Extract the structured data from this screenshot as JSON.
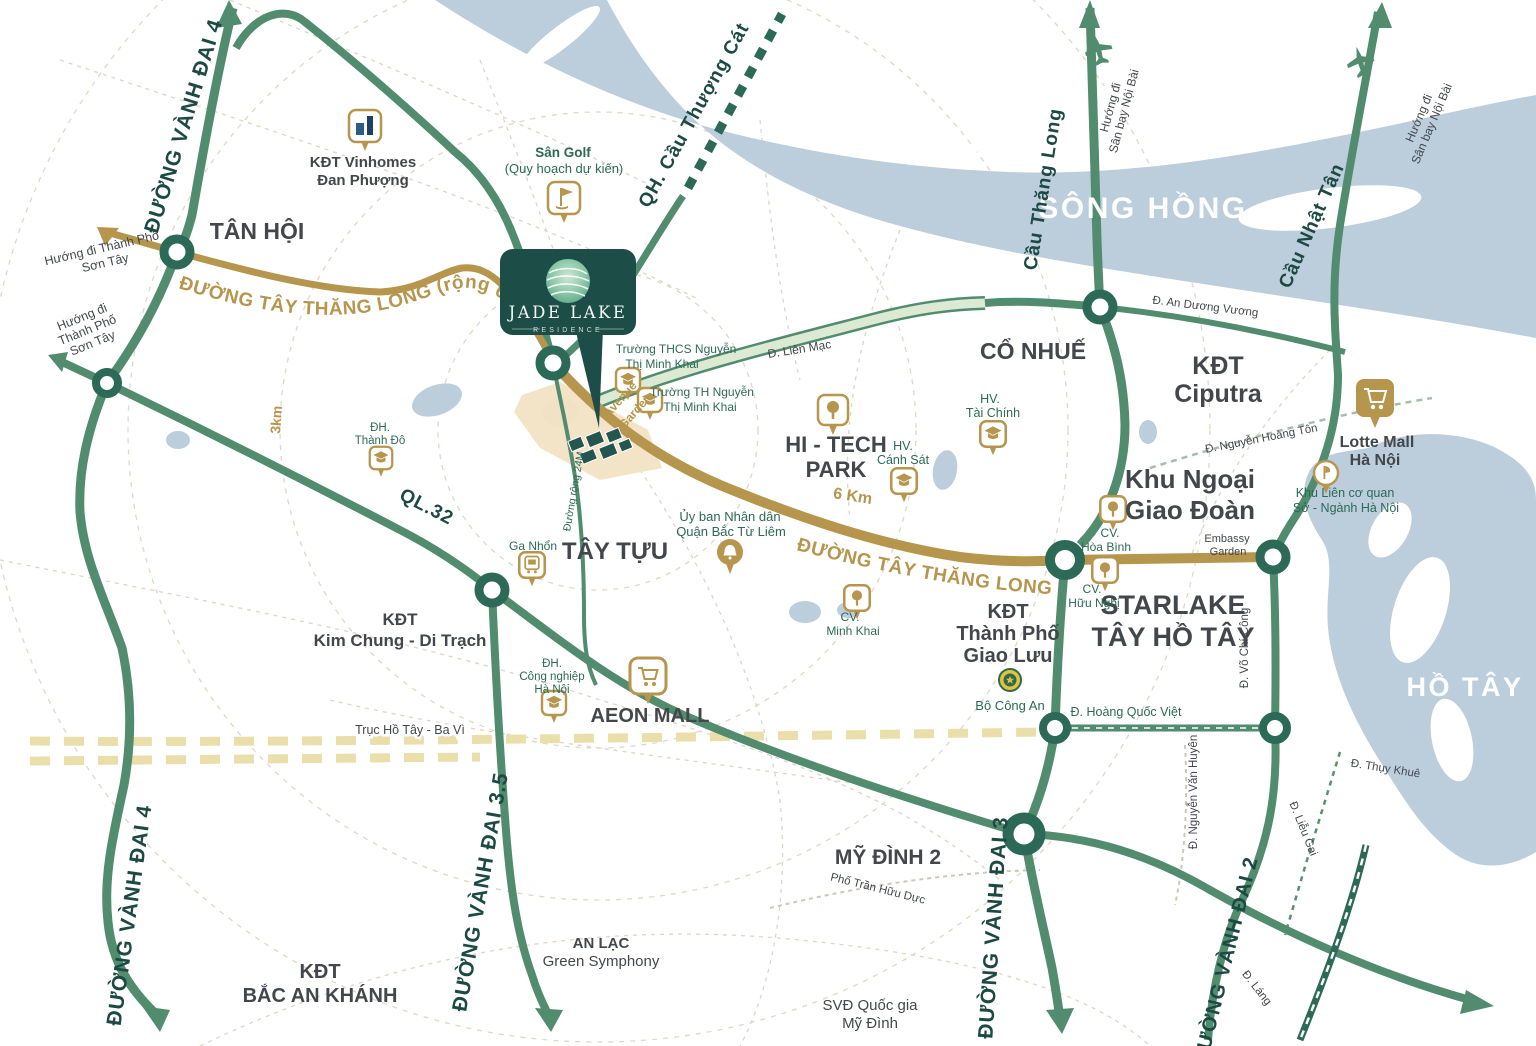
{
  "project": {
    "name": "JADE LAKE",
    "subtitle": "RESIDENCE"
  },
  "waterways": {
    "song_hong": "SÔNG HỒNG",
    "ho_tay": "HỒ TÂY"
  },
  "roads": {
    "vanh_dai_4": "ĐƯỜNG VÀNH ĐAI 4",
    "vanh_dai_4b": "ĐƯỜNG VÀNH ĐAI 4",
    "vanh_dai_35": "ĐƯỜNG VÀNH ĐAI 3.5",
    "vanh_dai_3": "ĐƯỜNG VÀNH ĐAI 3",
    "vanh_dai_2": "ĐƯỜNG VÀNH ĐAI 2",
    "ql32": "QL.32",
    "tay_thang_long_full": "ĐƯỜNG TÂY THĂNG LONG (rộng 60,5m)",
    "tay_thang_long": "ĐƯỜNG TÂY THĂNG LONG",
    "cau_thang_long": "Cầu Thăng Long",
    "cau_nhat_tan": "Cầu Nhật Tân",
    "qh_cau_thuong_cat": "QH. Cầu Thượng Cát",
    "lien_mac": "Đ. Liên Mạc",
    "an_duong_vuong": "Đ. An Dương Vương",
    "nguyen_hoang_ton": "Đ. Nguyễn Hoàng Tôn",
    "hoang_quoc_viet": "Đ. Hoàng Quốc Việt",
    "nguyen_van_huyen": "Đ. Nguyễn Văn Huyên",
    "vo_chi_cong": "Đ. Võ Chí Công",
    "thuy_khue": "Đ. Thụy Khuê",
    "lieu_gai": "Đ. Liễu Gai",
    "lang": "Đ. Láng",
    "tran_huu_duc": "Phố Trần Hữu Dực",
    "duong_rong_24m": "Đường rộng 24M",
    "truc_ho_tay_ba_vi": "Trục Hồ Tây - Ba Vì"
  },
  "directions": {
    "son_tay_a": {
      "l1": "Hướng đi Thành Phố",
      "l2": "Sơn Tây"
    },
    "son_tay_b": {
      "l1": "Hướng đi",
      "l2": "Thành Phố",
      "l3": "Sơn Tây"
    },
    "noi_bai_a": {
      "l1": "Hướng đi",
      "l2": "Sân bay Nội Bài"
    },
    "noi_bai_b": {
      "l1": "Hướng đi",
      "l2": "Sân bay Nội Bài"
    }
  },
  "distances": {
    "ring_3km": "3km",
    "road_6km": "6 Km"
  },
  "areas": {
    "tan_hoi": "TÂN HỘI",
    "co_nhue": "CỔ NHUẾ",
    "tay_tuu": "TÂY TỰU",
    "my_dinh_2": "MỸ ĐÌNH 2",
    "ciputra": {
      "l1": "KĐT",
      "l2": "Ciputra"
    },
    "khu_ngoai_giao": {
      "l1": "Khu Ngoại",
      "l2": "Giao Đoàn"
    },
    "starlake": {
      "l1": "STARLAKE",
      "l2": "TÂY HỒ TÂY"
    },
    "giao_luu": {
      "l1": "KĐT",
      "l2": "Thành Phố",
      "l3": "Giao Lưu"
    },
    "kim_chung": {
      "l1": "KĐT",
      "l2": "Kim Chung - Di Trạch"
    },
    "bac_an_khanh": {
      "l1": "KĐT",
      "l2": "BẮC AN KHÁNH"
    },
    "an_lac": {
      "l1": "AN LẠC",
      "l2": "Green Symphony"
    },
    "svd_my_dinh": {
      "l1": "SVĐ Quốc gia",
      "l2": "Mỹ Đình"
    },
    "embassy_garden": {
      "l1": "Embassy",
      "l2": "Garden"
    },
    "avenue_garden": {
      "l1": "Avenue",
      "l2": "Garden"
    }
  },
  "pois": {
    "vinhomes": {
      "l1": "KĐT Vinhomes",
      "l2": "Đan Phượng"
    },
    "san_golf": {
      "l1": "Sân Golf",
      "l2": "(Quy hoạch dự kiến)"
    },
    "thcs_minh_khai": {
      "l1": "Trường THCS Nguyễn",
      "l2": "Thị Minh Khai"
    },
    "th_minh_khai": {
      "l1": "Trường TH Nguyễn",
      "l2": "Thị Minh Khai"
    },
    "hitech_park": {
      "l1": "HI - TECH",
      "l2": "PARK"
    },
    "hv_canh_sat": {
      "l1": "HV.",
      "l2": "Cánh Sát"
    },
    "hv_tai_chinh": {
      "l1": "HV.",
      "l2": "Tài Chính"
    },
    "uy_ban": {
      "l1": "Ủy ban Nhân dân",
      "l2": "Quận Bắc Từ Liêm"
    },
    "cv_hoa_binh": {
      "l1": "CV.",
      "l2": "Hòa Bình"
    },
    "cv_huu_nghi": {
      "l1": "CV.",
      "l2": "Hữu Nghị"
    },
    "cv_minh_khai": {
      "l1": "CV.",
      "l2": "Minh Khai"
    },
    "aeon_mall": {
      "l1": "AEON MALL"
    },
    "dh_cong_nghiep": {
      "l1": "ĐH.",
      "l2": "Công nghiệp",
      "l3": "Hà Nội"
    },
    "ga_nhon": {
      "l1": "Ga Nhổn"
    },
    "dh_thanh_do": {
      "l1": "ĐH.",
      "l2": "Thành Đô"
    },
    "lotte_mall": {
      "l1": "Lotte Mall",
      "l2": "Hà Nội"
    },
    "khu_lien_co_quan": {
      "l1": "Khu Liên cơ quan",
      "l2": "Sở - Ngành Hà Nội"
    },
    "bo_cong_an": {
      "l1": "Bộ Công An"
    }
  },
  "colors": {
    "road_green": "#518c6e",
    "road_gold": "#b6954d",
    "teal_dark": "#1c4d47",
    "river_blue": "#bccddc"
  }
}
